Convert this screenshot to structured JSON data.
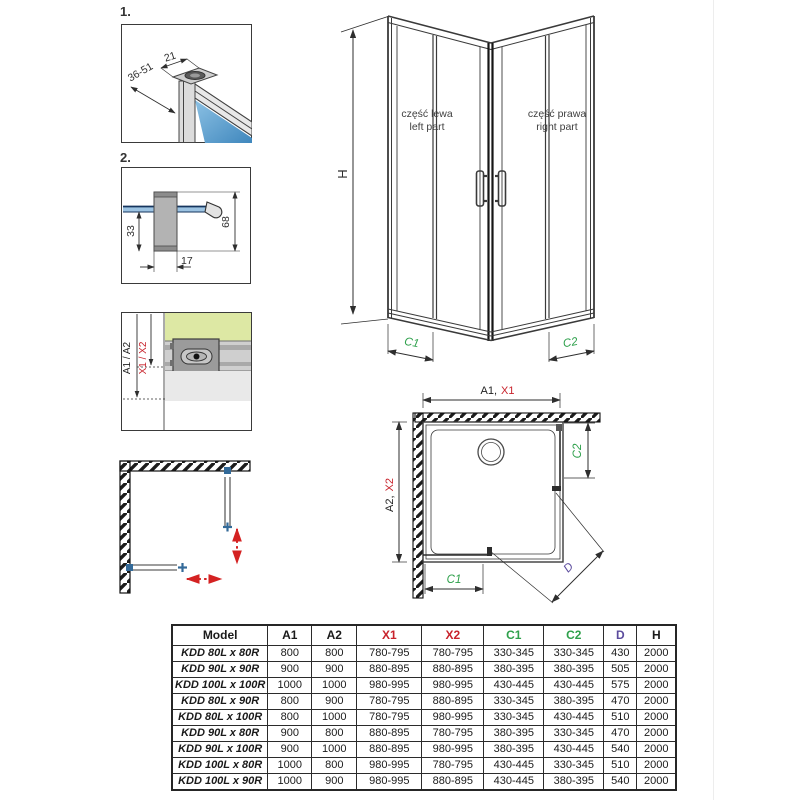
{
  "colors": {
    "red": "#c8232c",
    "green": "#2ea04b",
    "purple": "#5b4b9d",
    "line": "#2e2e2e",
    "glass_blue": "#5a9fd0",
    "wall_green": "#dde8a4"
  },
  "details": {
    "item1": {
      "index": "1.",
      "dim_top": "21",
      "dim_side": "36-51"
    },
    "item2": {
      "index": "2.",
      "dim_inner": "33",
      "dim_outer": "68",
      "dim_width": "17"
    },
    "item3": {
      "label_black": "A1 / A2",
      "label_red": "X1 / X2"
    }
  },
  "front_view": {
    "height_label": "H",
    "left_part_pl": "część lewa",
    "left_part_en": "left part",
    "right_part_pl": "część prawa",
    "right_part_en": "right part",
    "c1": "C1",
    "c2": "C2"
  },
  "plan_view": {
    "width_black": "A1,",
    "width_red": "X1",
    "depth_black": "A2,",
    "depth_red": "X2",
    "c1": "C1",
    "c2": "C2",
    "d": "D"
  },
  "table": {
    "headers": [
      {
        "label": "Model",
        "color": "#1a1a1a"
      },
      {
        "label": "A1",
        "color": "#1a1a1a"
      },
      {
        "label": "A2",
        "color": "#1a1a1a"
      },
      {
        "label": "X1",
        "color": "#c8232c"
      },
      {
        "label": "X2",
        "color": "#c8232c"
      },
      {
        "label": "C1",
        "color": "#2ea04b"
      },
      {
        "label": "C2",
        "color": "#2ea04b"
      },
      {
        "label": "D",
        "color": "#5b4b9d"
      },
      {
        "label": "H",
        "color": "#1a1a1a"
      }
    ],
    "col_widths": [
      88,
      39,
      40,
      60,
      57,
      55,
      55,
      28,
      34
    ],
    "rows": [
      [
        "KDD 80L x 80R",
        "800",
        "800",
        "780-795",
        "780-795",
        "330-345",
        "330-345",
        "430",
        "2000"
      ],
      [
        "KDD 90L x 90R",
        "900",
        "900",
        "880-895",
        "880-895",
        "380-395",
        "380-395",
        "505",
        "2000"
      ],
      [
        "KDD 100L x 100R",
        "1000",
        "1000",
        "980-995",
        "980-995",
        "430-445",
        "430-445",
        "575",
        "2000"
      ],
      [
        "KDD 80L x 90R",
        "800",
        "900",
        "780-795",
        "880-895",
        "330-345",
        "380-395",
        "470",
        "2000"
      ],
      [
        "KDD 80L x 100R",
        "800",
        "1000",
        "780-795",
        "980-995",
        "330-345",
        "430-445",
        "510",
        "2000"
      ],
      [
        "KDD 90L x 80R",
        "900",
        "800",
        "880-895",
        "780-795",
        "380-395",
        "330-345",
        "470",
        "2000"
      ],
      [
        "KDD 90L x 100R",
        "900",
        "1000",
        "880-895",
        "980-995",
        "380-395",
        "430-445",
        "540",
        "2000"
      ],
      [
        "KDD 100L x 80R",
        "1000",
        "800",
        "980-995",
        "780-795",
        "430-445",
        "330-345",
        "510",
        "2000"
      ],
      [
        "KDD 100L x 90R",
        "1000",
        "900",
        "980-995",
        "880-895",
        "430-445",
        "380-395",
        "540",
        "2000"
      ]
    ]
  }
}
